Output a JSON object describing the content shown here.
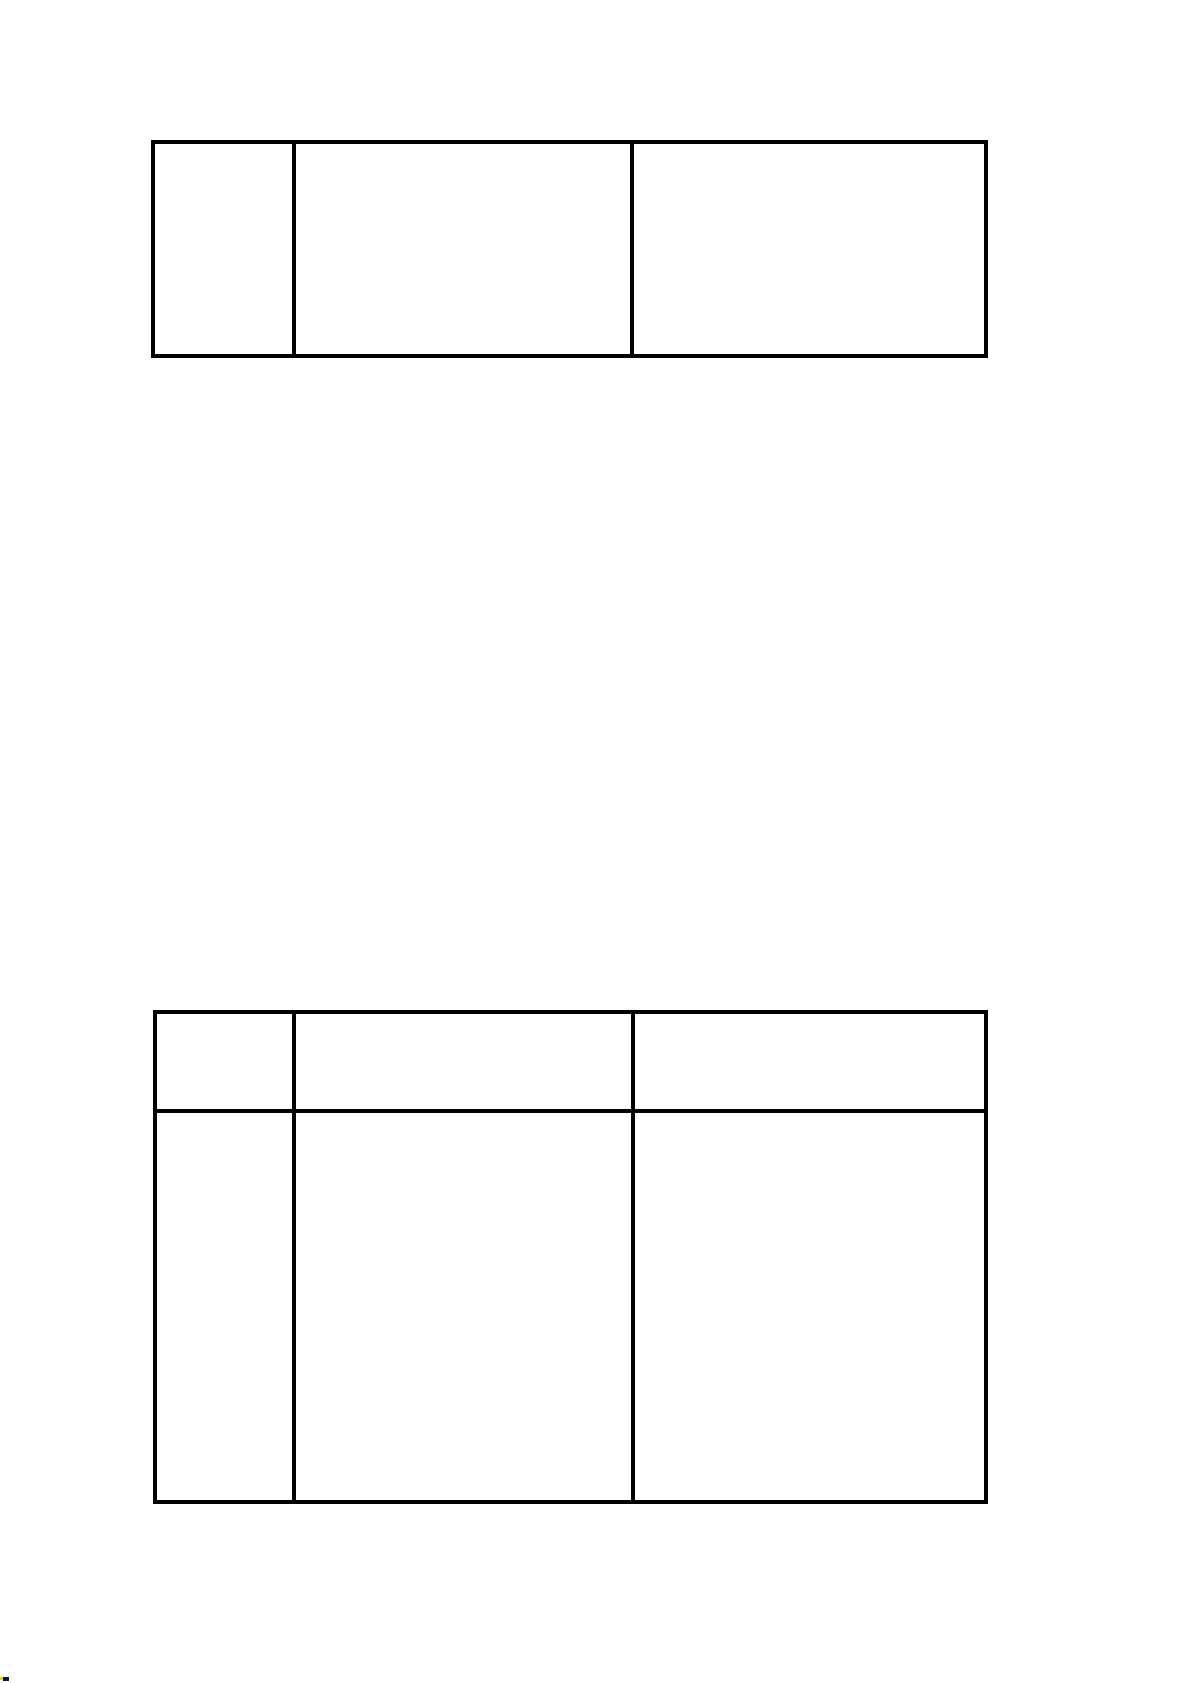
{
  "page": {
    "background": "#ffffff",
    "table_border_color": "#000000"
  },
  "table_top": {
    "rows": 1,
    "columns": 3,
    "cells": {
      "r0c0": "",
      "r0c1": "",
      "r0c2": ""
    }
  },
  "table_bottom": {
    "rows": 2,
    "columns": 3,
    "cells": {
      "r0c0": "",
      "r0c1": "",
      "r0c2": "",
      "r1c0": "",
      "r1c1": "",
      "r1c2": ""
    }
  },
  "corner_artifact": {
    "yellow": "#e8d40c",
    "navy": "#111345"
  }
}
